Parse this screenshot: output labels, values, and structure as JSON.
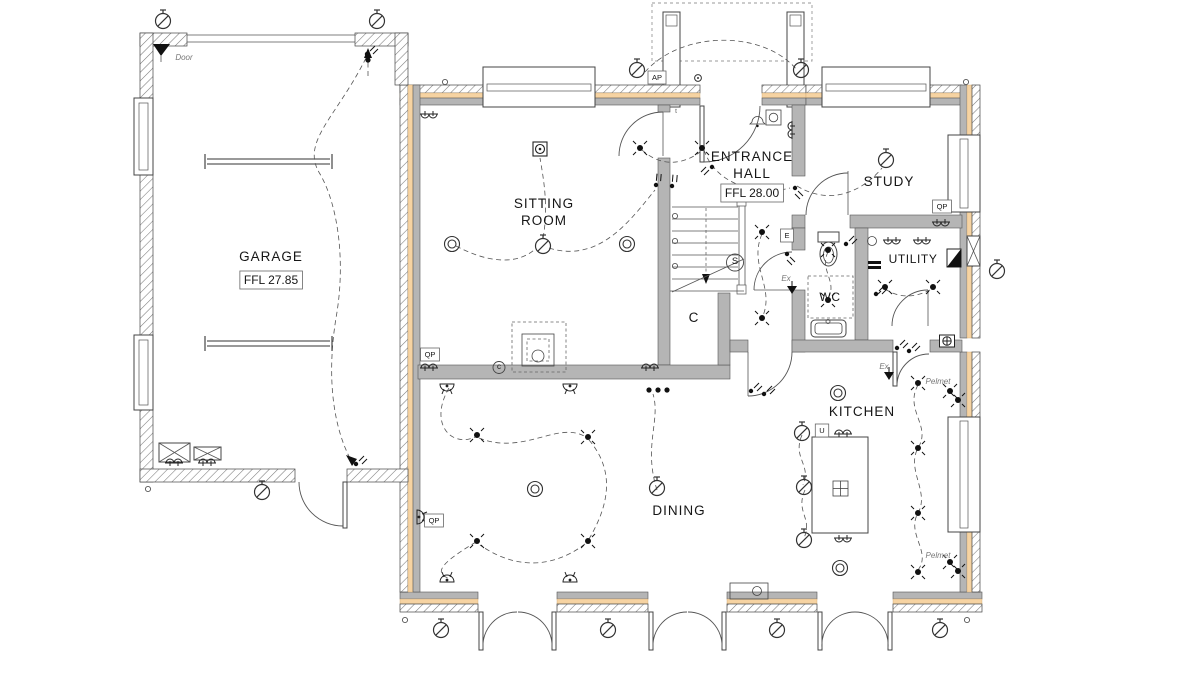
{
  "colors": {
    "insulation": "#f6d3a2",
    "wall": "#b5b5b5",
    "line": "#444444"
  },
  "rooms": [
    {
      "name": "GARAGE",
      "ffl": "FFL 27.85"
    },
    {
      "name": "SITTING ROOM"
    },
    {
      "name": "ENTRANCE HALL",
      "ffl": "FFL 28.00"
    },
    {
      "name": "STUDY"
    },
    {
      "name": "UTILITY"
    },
    {
      "name": "WC"
    },
    {
      "name": "KITCHEN"
    },
    {
      "name": "DINING"
    },
    {
      "name": "C"
    }
  ],
  "labels": [
    {
      "id": "garage-name",
      "text": "GARAGE",
      "x": 271,
      "y": 261,
      "cls": "room"
    },
    {
      "id": "garage-ffl",
      "text": "FFL 27.85",
      "x": 271,
      "y": 284,
      "cls": "ffl"
    },
    {
      "id": "sitting-line1",
      "text": "SITTING",
      "x": 544,
      "y": 208,
      "cls": "room"
    },
    {
      "id": "sitting-line2",
      "text": "ROOM",
      "x": 544,
      "y": 225,
      "cls": "room"
    },
    {
      "id": "hall-line1",
      "text": "ENTRANCE",
      "x": 752,
      "y": 161,
      "cls": "room"
    },
    {
      "id": "hall-line2",
      "text": "HALL",
      "x": 752,
      "y": 178,
      "cls": "room"
    },
    {
      "id": "hall-ffl",
      "text": "FFL 28.00",
      "x": 752,
      "y": 197,
      "cls": "ffl"
    },
    {
      "id": "study-name",
      "text": "STUDY",
      "x": 889,
      "y": 186,
      "cls": "room"
    },
    {
      "id": "utility-name",
      "text": "UTILITY",
      "x": 913,
      "y": 263,
      "cls": "room-sm"
    },
    {
      "id": "wc-name",
      "text": "WC",
      "x": 830,
      "y": 301,
      "cls": "room-sm"
    },
    {
      "id": "kitchen-name",
      "text": "KITCHEN",
      "x": 862,
      "y": 416,
      "cls": "room"
    },
    {
      "id": "dining-name",
      "text": "DINING",
      "x": 679,
      "y": 515,
      "cls": "room"
    },
    {
      "id": "cupboard-c",
      "text": "C",
      "x": 694,
      "y": 322,
      "cls": "room"
    },
    {
      "id": "door-note",
      "text": "Door",
      "x": 184,
      "y": 60,
      "cls": "note"
    },
    {
      "id": "pelmet-1",
      "text": "Pelmet",
      "x": 938,
      "y": 384,
      "cls": "note"
    },
    {
      "id": "pelmet-2",
      "text": "Pelmet",
      "x": 938,
      "y": 558,
      "cls": "note"
    },
    {
      "id": "ex-1",
      "text": "Ex",
      "x": 786,
      "y": 281,
      "cls": "note"
    },
    {
      "id": "ex-2",
      "text": "Ex",
      "x": 884,
      "y": 369,
      "cls": "note"
    },
    {
      "id": "qp-1",
      "text": "QP",
      "x": 430,
      "y": 357,
      "cls": "tag"
    },
    {
      "id": "qp-2",
      "text": "QP",
      "x": 434,
      "y": 523,
      "cls": "tag"
    },
    {
      "id": "qp-3",
      "text": "QP",
      "x": 942,
      "y": 209,
      "cls": "tag"
    },
    {
      "id": "ap-tag",
      "text": "AP",
      "x": 657,
      "y": 80,
      "cls": "tag"
    },
    {
      "id": "u-tag",
      "text": "U",
      "x": 822,
      "y": 433,
      "cls": "tag"
    },
    {
      "id": "e-tag",
      "text": "E",
      "x": 787,
      "y": 238,
      "cls": "tag"
    },
    {
      "id": "smoke-s",
      "text": "S",
      "x": 735,
      "y": 264,
      "cls": "circled"
    },
    {
      "id": "c-mark",
      "text": "c",
      "x": 499,
      "y": 369,
      "cls": "circled-sm"
    },
    {
      "id": "t-mark",
      "text": "t",
      "x": 676,
      "y": 113,
      "cls": "tiny"
    }
  ],
  "symbols": [
    {
      "t": "pend",
      "x": 163,
      "y": 21
    },
    {
      "t": "pend",
      "x": 377,
      "y": 21
    },
    {
      "t": "pend",
      "x": 637,
      "y": 70
    },
    {
      "t": "pend",
      "x": 801,
      "y": 70
    },
    {
      "t": "pend",
      "x": 886,
      "y": 160
    },
    {
      "t": "pend",
      "x": 997,
      "y": 271
    },
    {
      "t": "pend",
      "x": 262,
      "y": 492
    },
    {
      "t": "pend",
      "x": 441,
      "y": 630
    },
    {
      "t": "pend",
      "x": 608,
      "y": 630
    },
    {
      "t": "pend",
      "x": 777,
      "y": 630
    },
    {
      "t": "pend",
      "x": 940,
      "y": 630
    },
    {
      "t": "pend",
      "x": 543,
      "y": 246
    },
    {
      "t": "pend",
      "x": 657,
      "y": 488
    },
    {
      "t": "pend",
      "x": 802,
      "y": 433
    },
    {
      "t": "pend",
      "x": 804,
      "y": 487
    },
    {
      "t": "pend",
      "x": 804,
      "y": 540
    },
    {
      "t": "ring",
      "x": 452,
      "y": 244
    },
    {
      "t": "ring",
      "x": 627,
      "y": 244
    },
    {
      "t": "ring",
      "x": 535,
      "y": 489
    },
    {
      "t": "ring",
      "x": 838,
      "y": 393
    },
    {
      "t": "ring",
      "x": 840,
      "y": 568
    },
    {
      "t": "down",
      "x": 640,
      "y": 148
    },
    {
      "t": "down",
      "x": 702,
      "y": 148
    },
    {
      "t": "down",
      "x": 762,
      "y": 232
    },
    {
      "t": "down",
      "x": 762,
      "y": 318
    },
    {
      "t": "down",
      "x": 828,
      "y": 250
    },
    {
      "t": "down",
      "x": 828,
      "y": 300
    },
    {
      "t": "down",
      "x": 885,
      "y": 287
    },
    {
      "t": "down",
      "x": 933,
      "y": 287
    },
    {
      "t": "down",
      "x": 477,
      "y": 435
    },
    {
      "t": "down",
      "x": 588,
      "y": 437
    },
    {
      "t": "down",
      "x": 477,
      "y": 541
    },
    {
      "t": "down",
      "x": 588,
      "y": 541
    },
    {
      "t": "down",
      "x": 918,
      "y": 383
    },
    {
      "t": "down",
      "x": 918,
      "y": 448
    },
    {
      "t": "down",
      "x": 918,
      "y": 513
    },
    {
      "t": "down",
      "x": 918,
      "y": 572
    },
    {
      "t": "down",
      "x": 950,
      "y": 391
    },
    {
      "t": "down",
      "x": 958,
      "y": 400
    },
    {
      "t": "down",
      "x": 950,
      "y": 562
    },
    {
      "t": "down",
      "x": 958,
      "y": 571
    },
    {
      "t": "wlight",
      "x": 447,
      "y": 384,
      "r": 0
    },
    {
      "t": "wlight",
      "x": 570,
      "y": 384,
      "r": 0
    },
    {
      "t": "wlight",
      "x": 447,
      "y": 582,
      "r": 180
    },
    {
      "t": "wlight",
      "x": 570,
      "y": 582,
      "r": 180
    },
    {
      "t": "wlight",
      "x": 417,
      "y": 517,
      "r": 270
    },
    {
      "t": "sock",
      "x": 429,
      "y": 114,
      "r": 0
    },
    {
      "t": "sock",
      "x": 429,
      "y": 368,
      "r": 180
    },
    {
      "t": "sock",
      "x": 650,
      "y": 368,
      "r": 180
    },
    {
      "t": "sock",
      "x": 174,
      "y": 463,
      "r": 180
    },
    {
      "t": "sock",
      "x": 207,
      "y": 463,
      "r": 180
    },
    {
      "t": "sock",
      "x": 892,
      "y": 240,
      "r": 0
    },
    {
      "t": "sock",
      "x": 922,
      "y": 240,
      "r": 0
    },
    {
      "t": "sock",
      "x": 941,
      "y": 222,
      "r": 0
    },
    {
      "t": "sock",
      "x": 843,
      "y": 434,
      "r": 180
    },
    {
      "t": "sock",
      "x": 843,
      "y": 538,
      "r": 0
    },
    {
      "t": "sock",
      "x": 792,
      "y": 130,
      "r": 90
    },
    {
      "t": "sw",
      "x": 656,
      "y": 185,
      "r": -40
    },
    {
      "t": "sw",
      "x": 672,
      "y": 186,
      "r": -40
    },
    {
      "t": "sw",
      "x": 712,
      "y": 167,
      "r": 180
    },
    {
      "t": "sw",
      "x": 795,
      "y": 188,
      "r": 90
    },
    {
      "t": "sw",
      "x": 846,
      "y": 244,
      "r": 0
    },
    {
      "t": "sw",
      "x": 787,
      "y": 254,
      "r": 90
    },
    {
      "t": "sw",
      "x": 876,
      "y": 294,
      "r": 0
    },
    {
      "t": "sw",
      "x": 897,
      "y": 348,
      "r": 0
    },
    {
      "t": "sw",
      "x": 909,
      "y": 351,
      "r": 0
    },
    {
      "t": "sw",
      "x": 751,
      "y": 391,
      "r": 0
    },
    {
      "t": "sw",
      "x": 764,
      "y": 394,
      "r": 0
    },
    {
      "t": "sw",
      "x": 367,
      "y": 54,
      "r": 0
    },
    {
      "t": "sw",
      "x": 356,
      "y": 464,
      "r": 0
    },
    {
      "t": "dot",
      "x": 649,
      "y": 390
    },
    {
      "t": "dot",
      "x": 658,
      "y": 390
    },
    {
      "t": "dot",
      "x": 667,
      "y": 390
    },
    {
      "t": "dot",
      "x": 368,
      "y": 60
    },
    {
      "t": "vent",
      "x": 445,
      "y": 82
    },
    {
      "t": "vent",
      "x": 966,
      "y": 82
    },
    {
      "t": "vent",
      "x": 148,
      "y": 489
    },
    {
      "t": "vent",
      "x": 405,
      "y": 620
    },
    {
      "t": "vent",
      "x": 967,
      "y": 620
    },
    {
      "t": "vent",
      "x": 675,
      "y": 216
    },
    {
      "t": "vent",
      "x": 675,
      "y": 241
    },
    {
      "t": "vent",
      "x": 675,
      "y": 266
    },
    {
      "t": "push",
      "x": 698,
      "y": 78
    },
    {
      "t": "heat",
      "x": 540,
      "y": 149
    },
    {
      "t": "spur",
      "x": 947,
      "y": 341
    },
    {
      "t": "fanex",
      "x": 792,
      "y": 290
    },
    {
      "t": "fanex",
      "x": 889,
      "y": 376
    },
    {
      "t": "cutri",
      "x": 954,
      "y": 258
    }
  ]
}
